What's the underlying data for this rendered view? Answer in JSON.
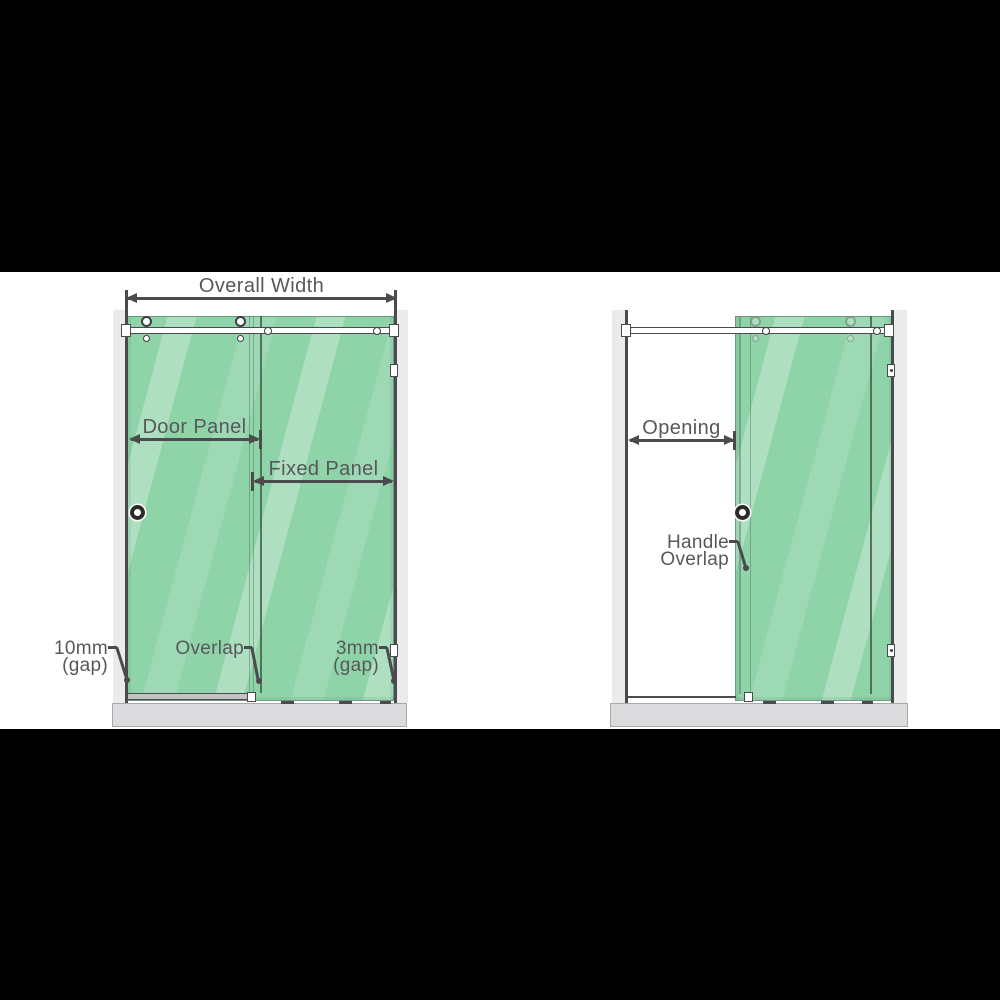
{
  "colors": {
    "background_black": "#000000",
    "content_white": "#ffffff",
    "glass_green": "#8fd3a9",
    "glass_highlight": "#b9e6ca",
    "wall_gray": "#ebebed",
    "base_gray": "#dcdcde",
    "line_dark": "#4b4b4d",
    "text_gray": "#58585b"
  },
  "closed_view": {
    "overall_width_label": "Overall Width",
    "door_panel_label": "Door Panel",
    "fixed_panel_label": "Fixed Panel",
    "left_gap_label_line1": "10mm",
    "left_gap_label_line2": "(gap)",
    "overlap_label": "Overlap",
    "right_gap_label_line1": "3mm",
    "right_gap_label_line2": "(gap)"
  },
  "open_view": {
    "opening_label": "Opening",
    "handle_overlap_label_line1": "Handle",
    "handle_overlap_label_line2": "Overlap"
  }
}
